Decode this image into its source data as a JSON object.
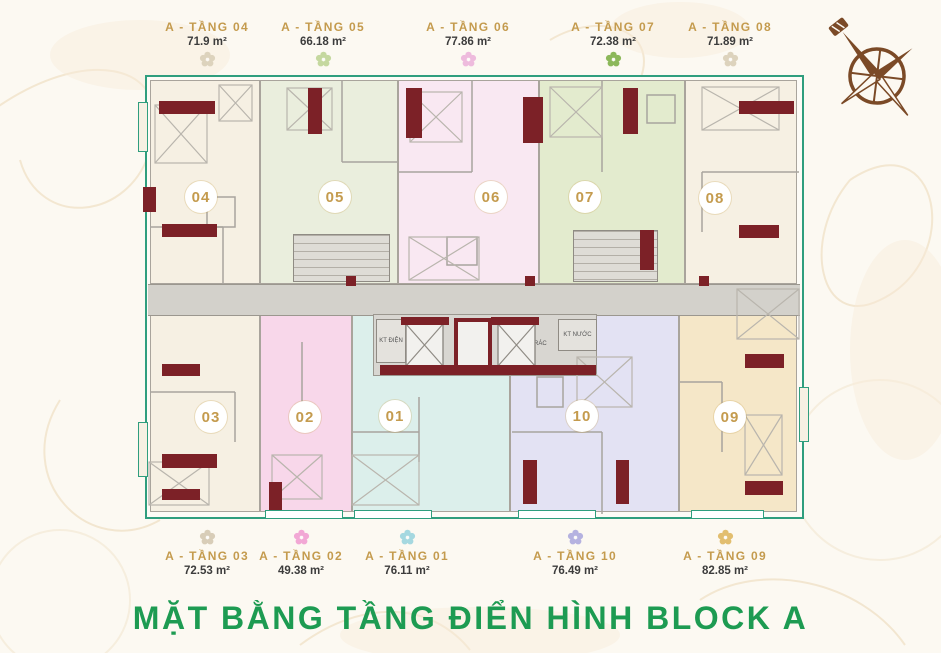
{
  "title": "MẶT BẰNG TẦNG ĐIỂN HÌNH BLOCK A",
  "colors": {
    "outline": "#2f9e7e",
    "gold": "#c49b4e",
    "green": "#1d9b52",
    "maroon": "#7c2127",
    "corridor": "#d3d1cb"
  },
  "top_labels": [
    {
      "name": "A - TẦNG 04",
      "area": "71.9 m²",
      "flower": "#ddd3bd"
    },
    {
      "name": "A - TẦNG 05",
      "area": "66.18 m²",
      "flower": "#c5d89f"
    },
    {
      "name": "A - TẦNG 06",
      "area": "77.86 m²",
      "flower": "#eebbdd"
    },
    {
      "name": "A - TẦNG 07",
      "area": "72.38 m²",
      "flower": "#8cb85a"
    },
    {
      "name": "A - TẦNG 08",
      "area": "71.89 m²",
      "flower": "#ddd3bd"
    }
  ],
  "bottom_labels": [
    {
      "name": "A - TẦNG 03",
      "area": "72.53 m²",
      "flower": "#d8cdb8"
    },
    {
      "name": "A - TẦNG 02",
      "area": "49.38 m²",
      "flower": "#f2a8d5"
    },
    {
      "name": "A - TẦNG 01",
      "area": "76.11 m²",
      "flower": "#a5d8e0"
    },
    {
      "name": "A - TẦNG 10",
      "area": "76.49 m²",
      "flower": "#b5b2e0"
    },
    {
      "name": "A - TẦNG 09",
      "area": "82.85 m²",
      "flower": "#e2be6f"
    }
  ],
  "plan": {
    "units": {
      "u04": {
        "number": "04",
        "fill": "#f6f0e3"
      },
      "u05": {
        "number": "05",
        "fill": "#eaeedd"
      },
      "u06": {
        "number": "06",
        "fill": "#f9e8f2"
      },
      "u07": {
        "number": "07",
        "fill": "#e3ebce"
      },
      "u08": {
        "number": "08",
        "fill": "#f6f0e3"
      },
      "u03": {
        "number": "03",
        "fill": "#f6f0e3"
      },
      "u02": {
        "number": "02",
        "fill": "#f8d7ea"
      },
      "u01": {
        "number": "01",
        "fill": "#dcefeb"
      },
      "u10": {
        "number": "10",
        "fill": "#e3e2f3"
      },
      "u09": {
        "number": "09",
        "fill": "#f5e7c8"
      }
    },
    "core": {
      "kt_dien": "KT ĐIỆN",
      "rac": "RÁC",
      "kt_nuoc": "KT NƯỚC"
    }
  }
}
